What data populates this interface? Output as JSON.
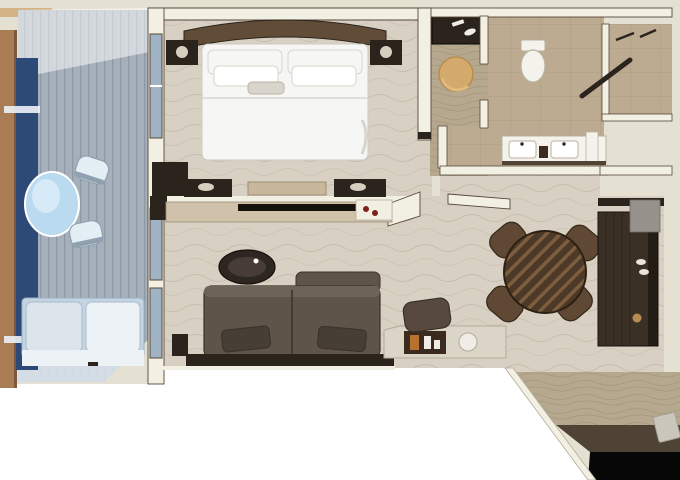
{
  "meta": {
    "title": "Top-down 3D rendered floor plan of a suite with balcony, bedroom, bathroom, living and dining areas",
    "type": "floor-plan-rendering"
  },
  "palette": {
    "bg": "#e4e1d2",
    "cutout": "#ffffff",
    "wall": "#f2efe3",
    "wall_edge": "#564737",
    "deck_base": "#a6b0ba",
    "deck_stripe": "#8d98a4",
    "deck_light": "#dce5ec",
    "railing": "#a97c54",
    "railing_dark": "#7d5a3b",
    "glass_navy": "#2c4a75",
    "glass_pane": "#9fb3c4",
    "patio_table": "#badaf0",
    "patio_table_hi": "#ddeefa",
    "patio_chair": "#e4eef5",
    "patio_chair_edge": "#8fa1b0",
    "patio_sofa": "#c3d4e3",
    "patio_sofa_light": "#edf2f7",
    "carpet": "#d8d0c2",
    "carpet_wave": "#c2b9a8",
    "bed_white": "#f6f6f4",
    "bed_shadow": "#d9d5cc",
    "headboard": "#604c37",
    "dark_wood": "#2b241d",
    "night_lamp": "#d6cfc0",
    "bench": "#c9b79b",
    "console_wood": "#cfc1aa",
    "console_edge": "#9b8e77",
    "tv_black": "#16130f",
    "decor_red": "#7e201b",
    "sofa_brown": "#5e544a",
    "sofa_hi": "#6d6358",
    "sofa_dark": "#473e35",
    "sofa_edge": "#3a322a",
    "coffee_table": "#2e2721",
    "coffee_table_hi": "#4b423a",
    "desk_top": "#dbd5c7",
    "desk_edge": "#b3ab9a",
    "tray_brown": "#3b2b1e",
    "tray_orange": "#b9712f",
    "card_white": "#efede6",
    "chair_brown": "#57493d",
    "dining_wood": "#4d3928",
    "dining_stripe": "#7c5e3e",
    "dining_edge": "#2c2013",
    "dining_chair": "#5f4935",
    "dining_chair_dark": "#342617",
    "bar_cabinet": "#3b3026",
    "bar_line": "#2a211a",
    "bar_shadow": "#15100c",
    "bar_gray": "#96918a",
    "bar_item": "#e8e5da",
    "marble": "#bcaa91",
    "marble_line": "#a39172",
    "white_fixture": "#f3f2eb",
    "fixture_line": "#b9b2a3",
    "ottoman": "#d3a96c",
    "ottoman_dark": "#b78c50",
    "ottoman_hi": "#e2bd80",
    "wood_floor": "#b6a88e",
    "wood_grain": "#998b70",
    "entry_dark": "#4e4335",
    "black": "#070707",
    "doormat": "#cbc6bb",
    "doormat_edge": "#a8a298",
    "cream_cap": "#d4b486"
  },
  "elements": [
    "balcony-deck",
    "balcony-railing",
    "patio-table",
    "patio-chairs",
    "patio-sofa",
    "bedroom-bed",
    "headboard",
    "nightstands",
    "foot-bench",
    "dresser",
    "tv-console",
    "living-sofa",
    "coffee-table",
    "writing-desk",
    "desk-chair",
    "dining-table",
    "dining-chairs",
    "bar-cabinet",
    "bathroom-toilet",
    "double-vanity",
    "shower",
    "dressing-vanity",
    "ottoman",
    "entry-floor",
    "doormat"
  ]
}
